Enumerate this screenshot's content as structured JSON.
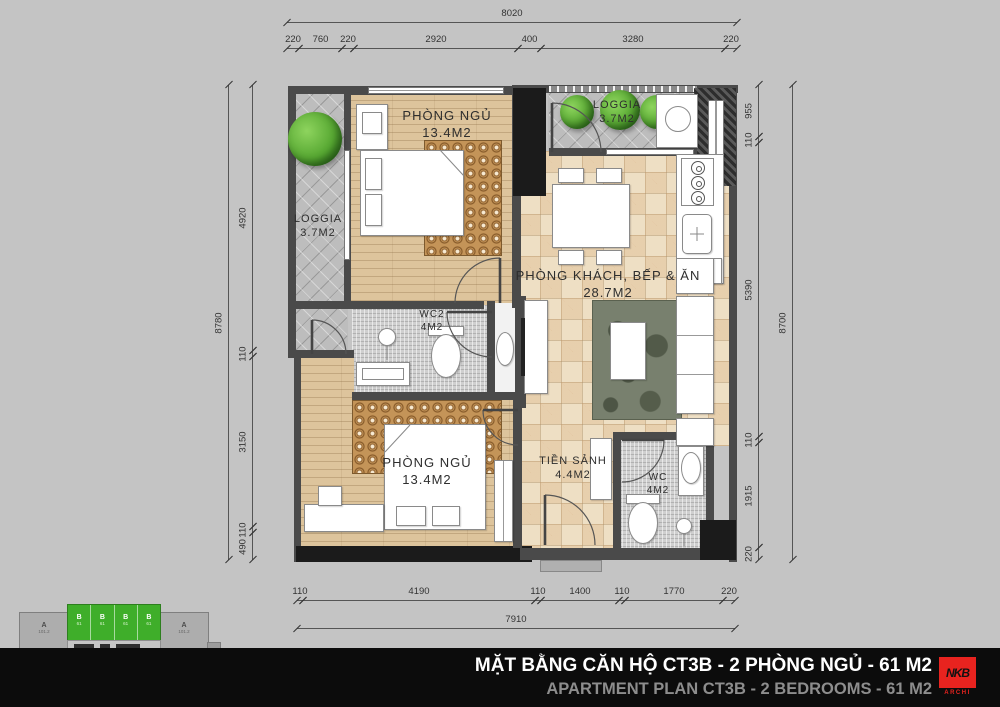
{
  "dims": {
    "top": {
      "total": "8020",
      "segments": [
        "220",
        "760",
        "220",
        "2920",
        "400",
        "3280",
        "220"
      ]
    },
    "bottom": {
      "total": "7910",
      "segments": [
        "110",
        "4190",
        "110",
        "1400",
        "110",
        "1770",
        "220"
      ]
    },
    "left": {
      "total": "8780",
      "segments": [
        "4920",
        "110",
        "3150",
        "110",
        "490"
      ]
    },
    "right": {
      "total": "8700",
      "segments": [
        "955",
        "110",
        "5390",
        "110",
        "1915",
        "220"
      ]
    }
  },
  "rooms": {
    "bedroom1": {
      "name": "PHÒNG NGỦ",
      "area": "13.4M2"
    },
    "loggia1": {
      "name": "LOGGIA",
      "area": "3.7M2"
    },
    "loggia2": {
      "name": "LOGGIA",
      "area": "3.7M2"
    },
    "living": {
      "name": "PHÒNG KHÁCH, BẾP & ĂN",
      "area": "28.7M2"
    },
    "wc2": {
      "name": "WC2",
      "area": "4M2"
    },
    "hall": {
      "name": "TIỀN SẢNH",
      "area": "4.4M2"
    },
    "wc1": {
      "name": "WC",
      "area": "4M2"
    },
    "bedroom2": {
      "name": "PHÒNG NGỦ",
      "area": "13.4M2"
    }
  },
  "title": {
    "vietnamese": "MẶT BẰNG CĂN HỘ CT3B - 2 PHÒNG NGỦ - 61 M2",
    "english": "APARTMENT PLAN CT3B - 2 BEDROOMS - 61 M2"
  },
  "logo": {
    "name": "NKB",
    "sub": "ARCHI"
  },
  "key_plan": {
    "unit_a": "A",
    "unit_a_sub": "101.2",
    "unit_b": "B",
    "unit_b_sub": "61"
  },
  "colors": {
    "background": "#c4c4c4",
    "wall": "#4a4a4a",
    "highlight_green": "#3fae2a",
    "logo_red": "#e8231f",
    "title_bar": "#0c0c0c"
  }
}
